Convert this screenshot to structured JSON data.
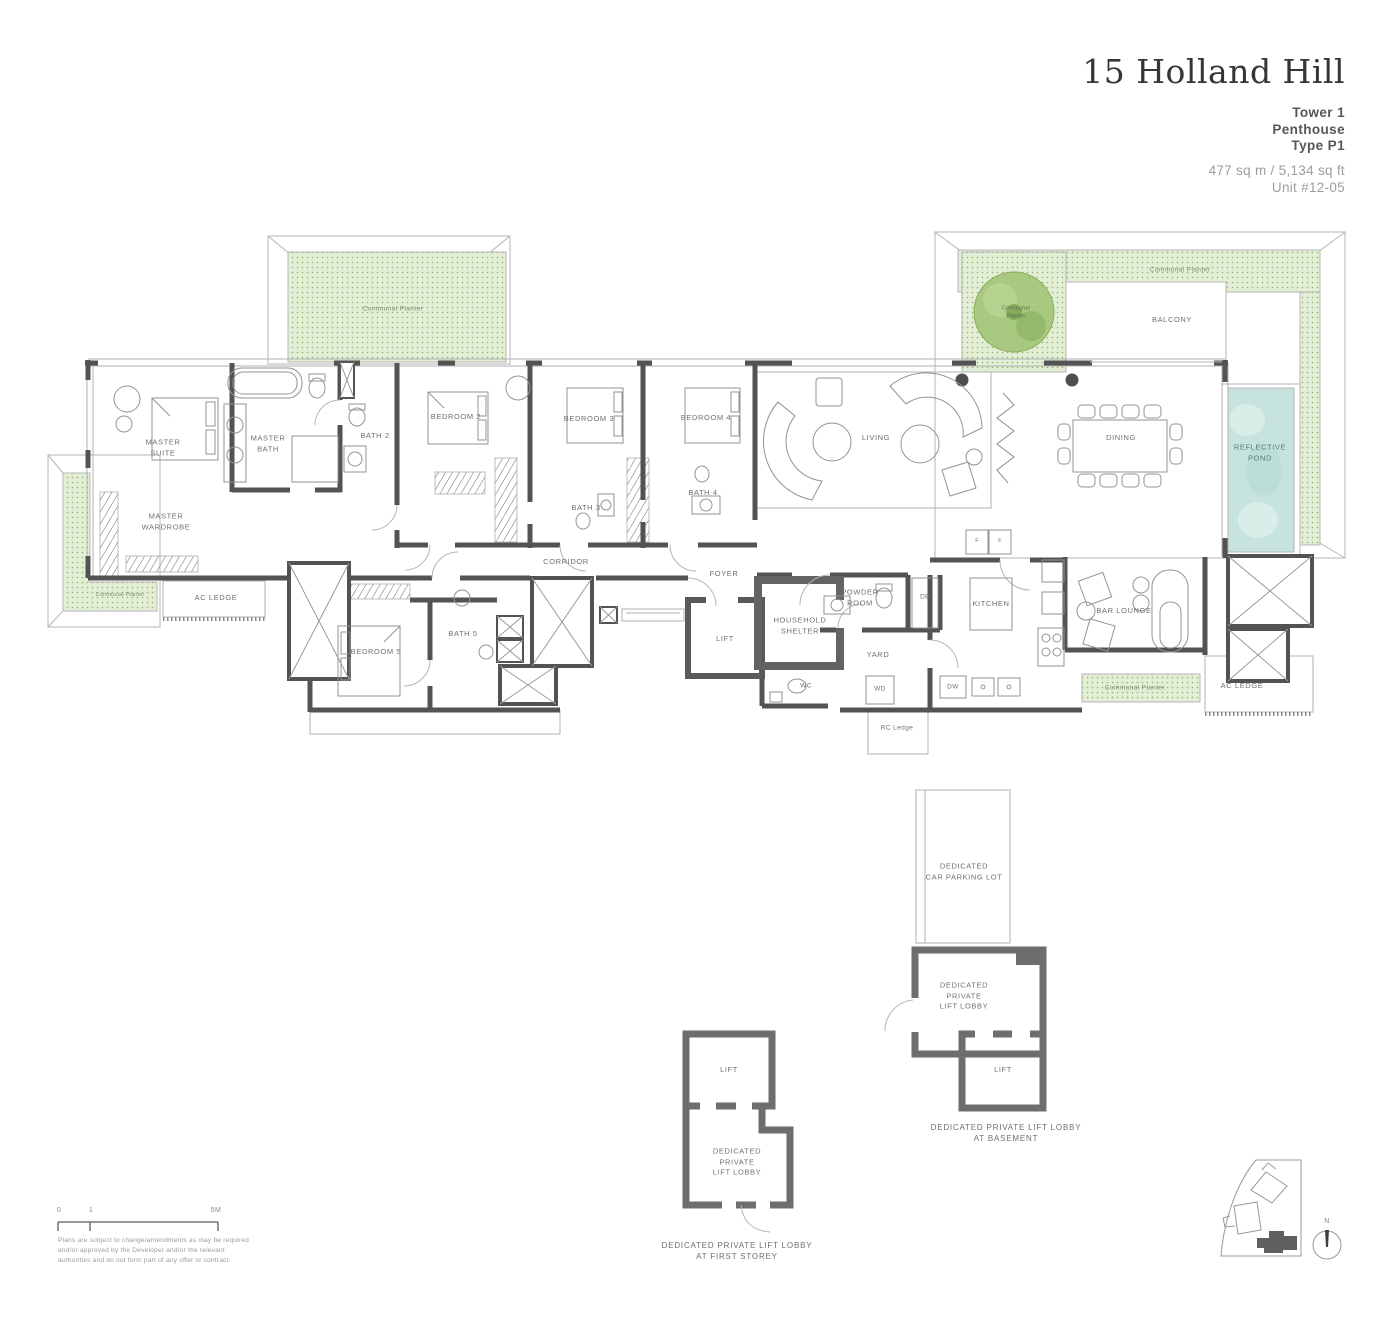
{
  "header": {
    "title": "15 Holland Hill",
    "tower": "Tower 1",
    "unit_type": "Penthouse",
    "type_code": "Type P1",
    "area": "477 sq m / 5,134 sq ft",
    "unit": "Unit #12-05"
  },
  "rooms": {
    "master_suite": "MASTER\nSUITE",
    "master_bath": "MASTER\nBATH",
    "bath_2": "BATH 2",
    "bedroom_2": "BEDROOM 2",
    "bedroom_3": "BEDROOM 3",
    "bedroom_4": "BEDROOM 4",
    "bath_3": "BATH 3",
    "bath_4": "BATH 4",
    "bedroom_5": "BEDROOM 5",
    "bath_5": "BATH 5",
    "master_wardrobe": "MASTER\nWARDROBE",
    "corridor": "CORRIDOR",
    "foyer": "FOYER",
    "lift": "LIFT",
    "household_shelter": "HOUSEHOLD\nSHELTER",
    "powder_room": "POWDER\nROOM",
    "wc": "WC",
    "yard": "YARD",
    "wd": "WD",
    "db": "DB",
    "dw": "DW",
    "kitchen": "KITCHEN",
    "bar_lounge": "BAR LOUNGE",
    "living": "LIVING",
    "dining": "DINING",
    "balcony": "BALCONY",
    "reflective_pond": "REFLECTIVE\nPOND",
    "ac_ledge": "AC LEDGE",
    "rc_ledge": "RC Ledge",
    "f": "F"
  },
  "planters": {
    "label": "Communal Planter",
    "tree": "Communal\nPlanter"
  },
  "lower": {
    "car_parking": "DEDICATED\nCAR PARKING LOT",
    "private_lobby": "DEDICATED\nPRIVATE\nLIFT LOBBY",
    "lift": "LIFT",
    "caption_basement": "DEDICATED PRIVATE LIFT LOBBY\nAT BASEMENT",
    "caption_first": "DEDICATED PRIVATE LIFT LOBBY\nAT FIRST STOREY"
  },
  "scale": {
    "zero": "0",
    "one": "1",
    "five": "5M"
  },
  "disclaimer": "Plans are subject to change/amendments as may be required\nand/or approved by the Developer and/or the relevant\nauthorities and do not form part of any offer or contract.",
  "compass": {
    "north": "N"
  },
  "colors": {
    "planter_fill": "#e3eed6",
    "planter_dot": "#92b465",
    "pond": "#c7e3df",
    "wall": "#535353",
    "label_text": "#6f6f6f"
  }
}
